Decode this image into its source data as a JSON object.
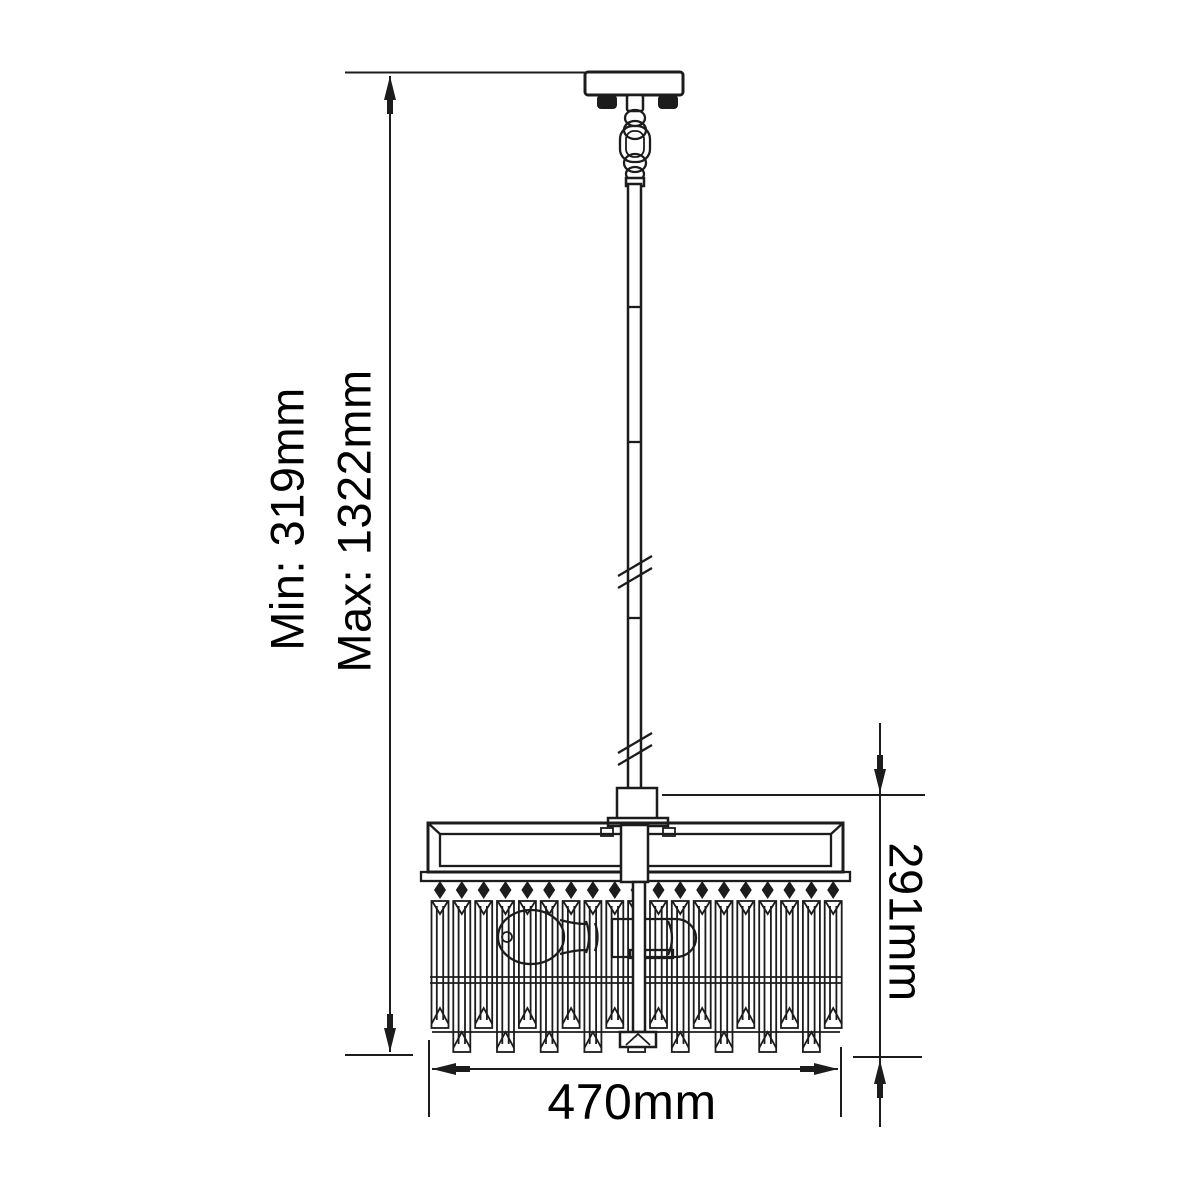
{
  "diagram": {
    "background_color": "#ffffff",
    "line_color": "#1c1c1c",
    "text_color": "#000000",
    "annotations": {
      "min_drop": "Min: 319mm",
      "max_drop": "Max: 1322mm",
      "shade_height": "291mm",
      "shade_width": "470mm"
    }
  }
}
